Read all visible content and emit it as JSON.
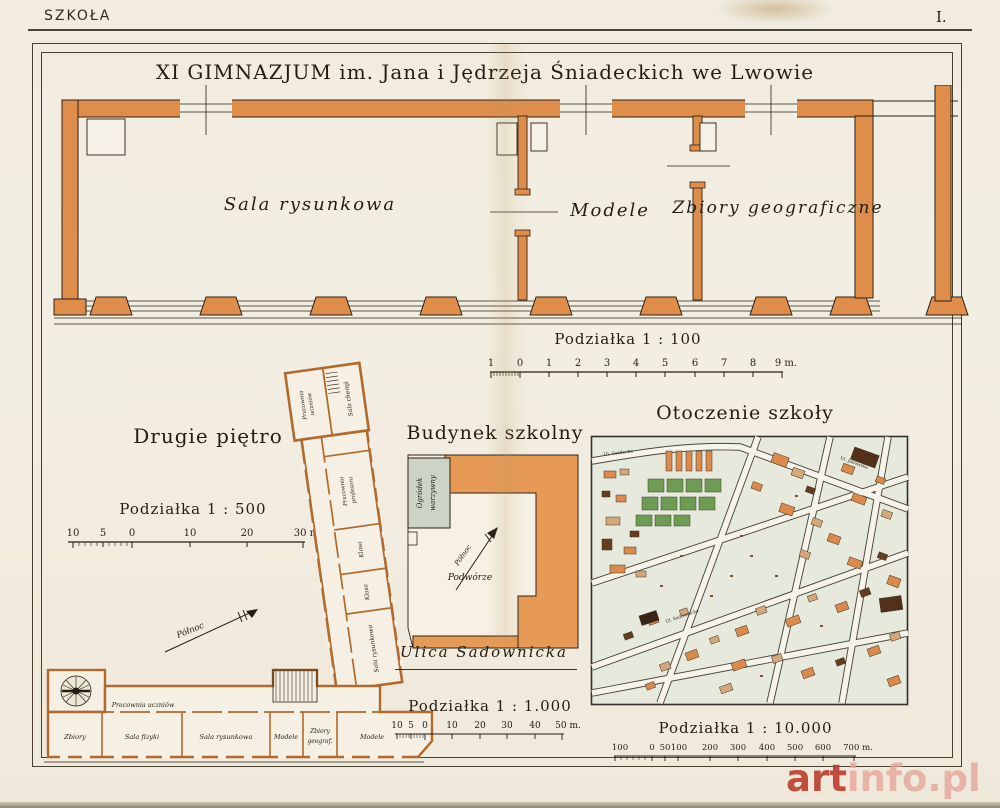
{
  "page": {
    "header_left": "SZKOŁA",
    "header_right": "I.",
    "title": "XI GIMNAZJUM im. Jana i Jędrzeja Śniadeckich we Lwowie"
  },
  "top_plan": {
    "room_1": "Sala rysunkowa",
    "room_2": "Modele",
    "room_3": "Zbiory geograficzne"
  },
  "scales": {
    "s100": {
      "title": "Podziałka 1 : 100",
      "ticks": [
        "1",
        "0",
        "1",
        "2",
        "3",
        "4",
        "5",
        "6",
        "7",
        "8",
        "9 m."
      ]
    },
    "s500": {
      "title": "Podziałka 1 : 500",
      "ticks": [
        "10",
        "5",
        "0",
        "10",
        "20",
        "30 m."
      ]
    },
    "s1000": {
      "title": "Podziałka 1 : 1.000",
      "ticks": [
        "10",
        "5",
        "0",
        "10",
        "20",
        "30",
        "40",
        "50 m."
      ]
    },
    "s10000": {
      "title": "Podziałka 1 : 10.000",
      "ticks": [
        "100",
        "0",
        "50",
        "100",
        "200",
        "300",
        "400",
        "500",
        "600",
        "700 m."
      ]
    }
  },
  "second_floor": {
    "title": "Drugie piętro",
    "north": "Północ",
    "wing_room_1a": "Pracownia",
    "wing_room_1b": "uczniów",
    "wing_room_2": "Sala chemji",
    "wing_room_3a": "Pracownia",
    "wing_room_3b": "profesora",
    "wing_room_4": "Klasa",
    "wing_room_5": "Klasa",
    "wing_room_6": "Sala rysunkowa",
    "corridor": "Pracownia uczniów",
    "room_zbiory": "Zbiory",
    "room_fizyki": "Sala fizyki",
    "room_rysunkowa": "Sala rysunkowa",
    "room_modele_1": "Modele",
    "room_zbiory_geo_a": "Zbiory",
    "room_zbiory_geo_b": "geograf.",
    "room_modele_2": "Modele"
  },
  "site_plan": {
    "title": "Budynek szkolny",
    "garden_a": "Ogródek",
    "garden_b": "warzywny",
    "north": "Północ",
    "courtyard": "Podwórze",
    "street": "Ulica Sadownicka"
  },
  "map": {
    "title": "Otoczenie szkoły",
    "street_grodecka": "Ul. Gródecka",
    "street_janowska": "Ul. Janowska",
    "street_sadownicka": "Ul. Sadownicka"
  },
  "watermark": {
    "bold": "art",
    "light": "info.pl"
  },
  "colors": {
    "wall": "#df8d4b",
    "paper": "#f3eee2",
    "map_green": "#6f9c55",
    "watermark_red": "#b93728"
  }
}
